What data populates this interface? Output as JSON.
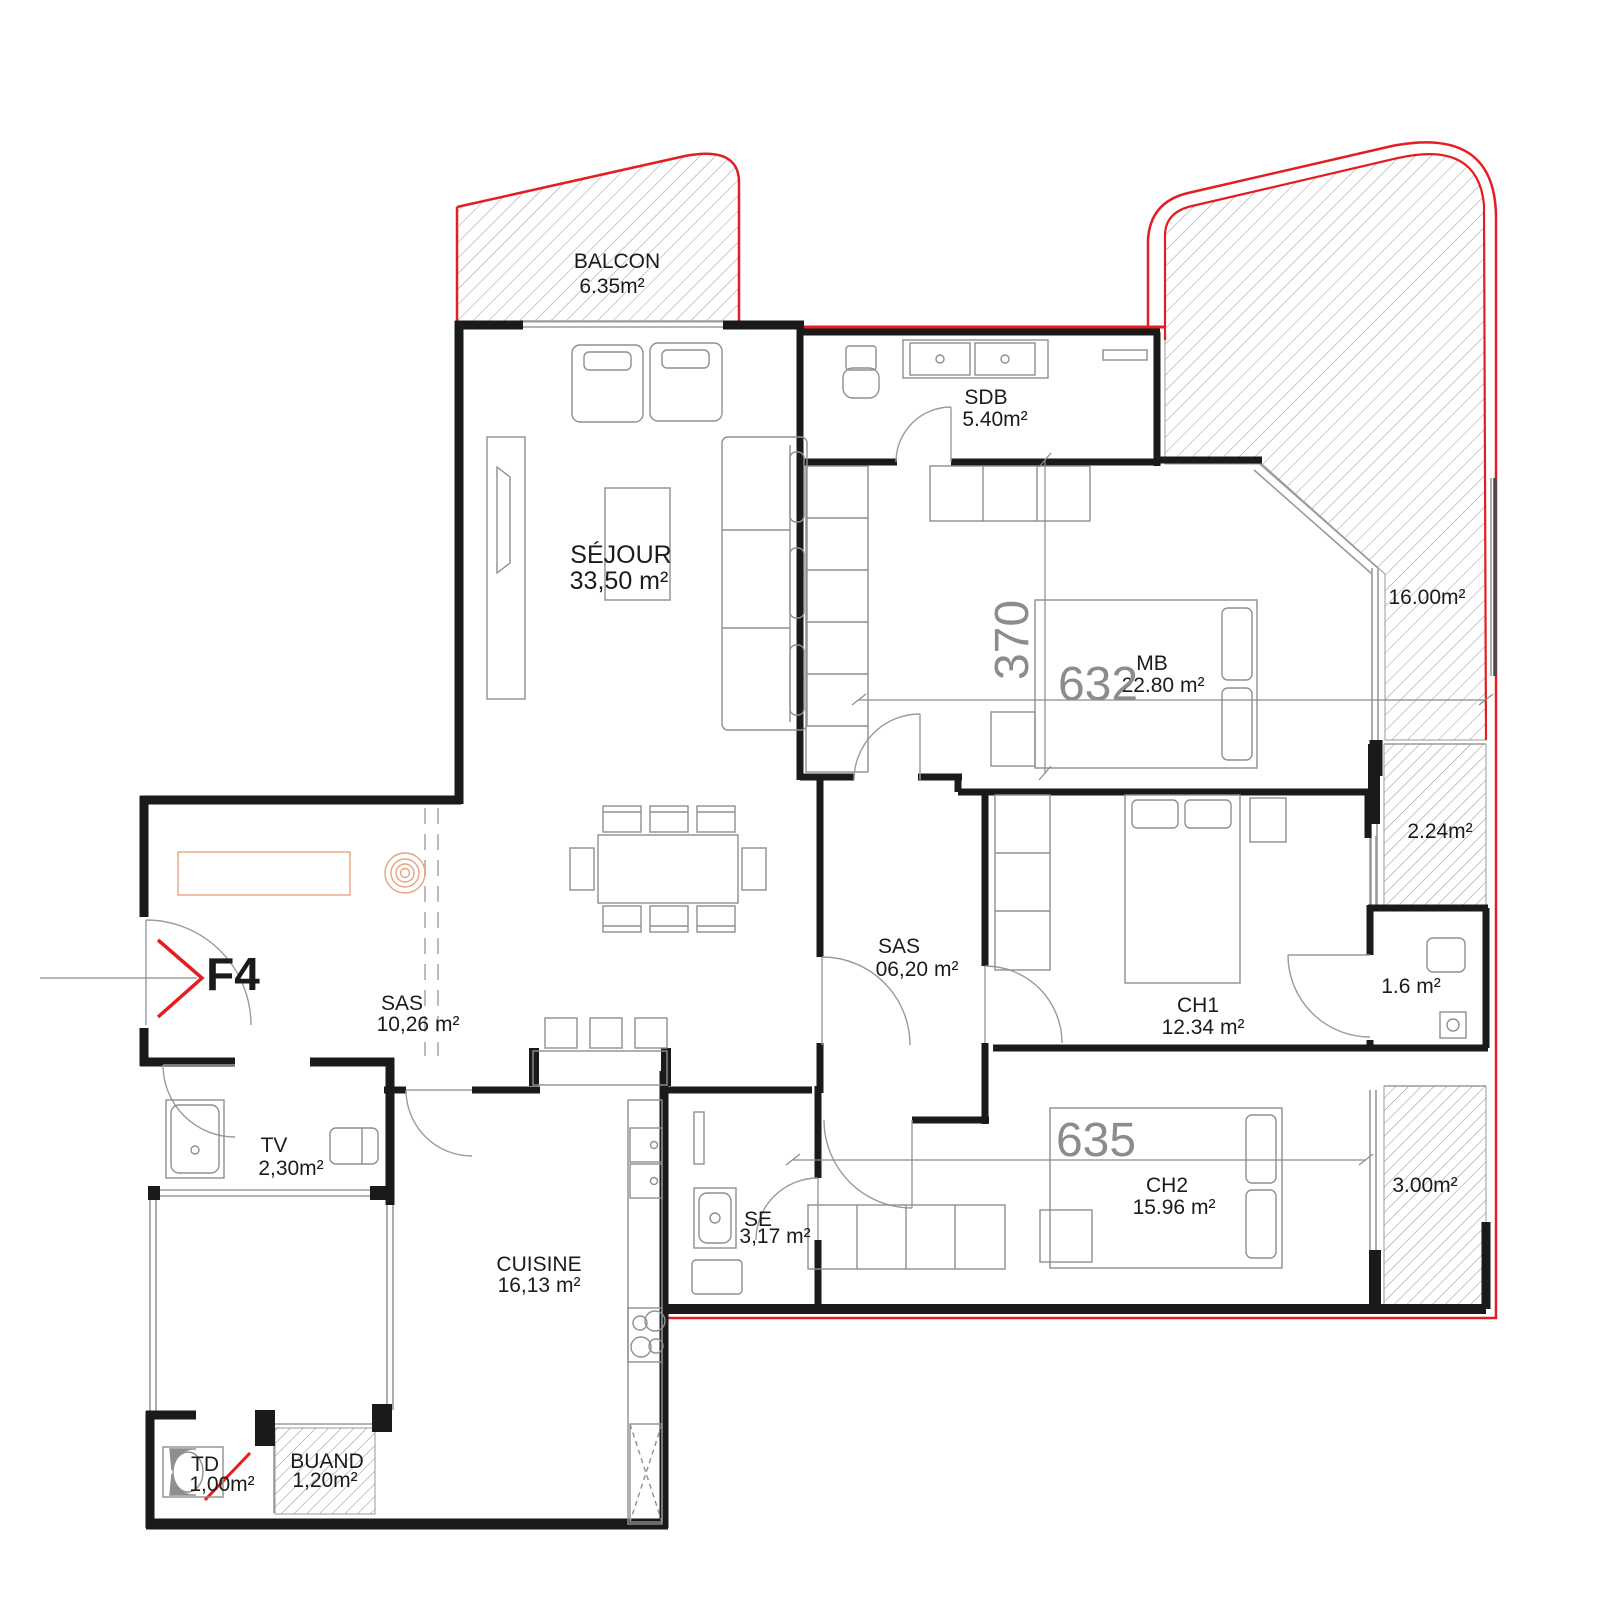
{
  "plan": {
    "unit": "F4",
    "rooms": {
      "balcon": {
        "name": "BALCON",
        "area": "6.35m²"
      },
      "sejour": {
        "name": "SÉJOUR",
        "area": "33,50 m²"
      },
      "sdb": {
        "name": "SDB",
        "area": "5.40m²"
      },
      "mb": {
        "name": "MB",
        "area": "22.80 m²"
      },
      "terrasse": {
        "area": "16.00m²"
      },
      "loggia_2_24": {
        "area": "2.24m²"
      },
      "sas_hall": {
        "name": "SAS",
        "area": "06,20 m²"
      },
      "ch1": {
        "name": "CH1",
        "area": "12.34 m²"
      },
      "wc": {
        "area": "1.6 m²"
      },
      "sas_entree": {
        "name": "SAS",
        "area": "10,26 m²"
      },
      "tv": {
        "name": "TV",
        "area": "2,30m²"
      },
      "ch2": {
        "name": "CH2",
        "area": "15.96 m²"
      },
      "loggia_3_00": {
        "area": "3.00m²"
      },
      "se": {
        "name": "SE",
        "area": "3,17 m²"
      },
      "cuisine": {
        "name": "CUISINE",
        "area": "16,13 m²"
      },
      "td": {
        "name": "TD",
        "area": "1,00m²"
      },
      "buand": {
        "name": "BUAND",
        "area": "1,20m²"
      }
    },
    "dimensions": {
      "mb_width": "632",
      "mb_depth": "370",
      "ch2_width": "635"
    },
    "colors": {
      "boundary_red": "#e41d20",
      "wall": "#1a1a1a",
      "furniture_gray": "#909090",
      "dimension_gray": "#8c8c8c",
      "accent_orange": "#e6a47e"
    }
  }
}
